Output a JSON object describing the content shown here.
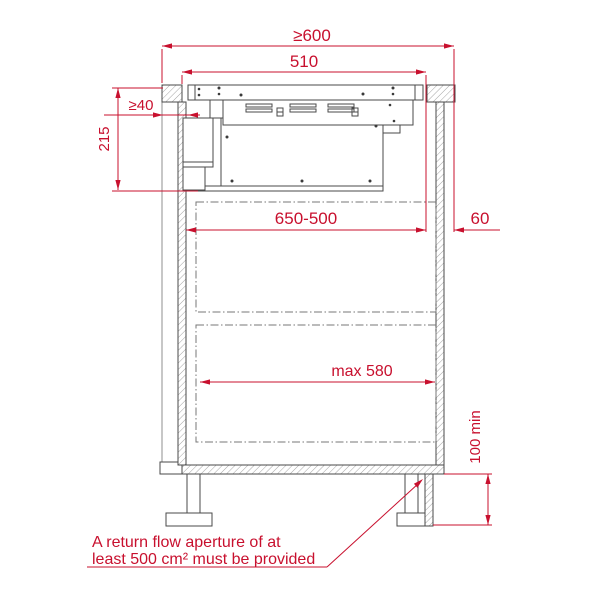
{
  "diagram": {
    "kind": "appliance-installation-section-drawing",
    "accent_color": "#c8102e",
    "line_color": "#4a4a4a",
    "dims": {
      "worktop_min": "≥600",
      "cutout": "510",
      "rear_clearance": "≥40",
      "install_depth": "215",
      "clearance_range": "650-500",
      "front_distance": "60",
      "drawer_max": "max 580",
      "plinth_min": "100 min"
    },
    "note": {
      "line1": "A return flow aperture of at",
      "line2": "least 500 cm² must be provided"
    }
  }
}
